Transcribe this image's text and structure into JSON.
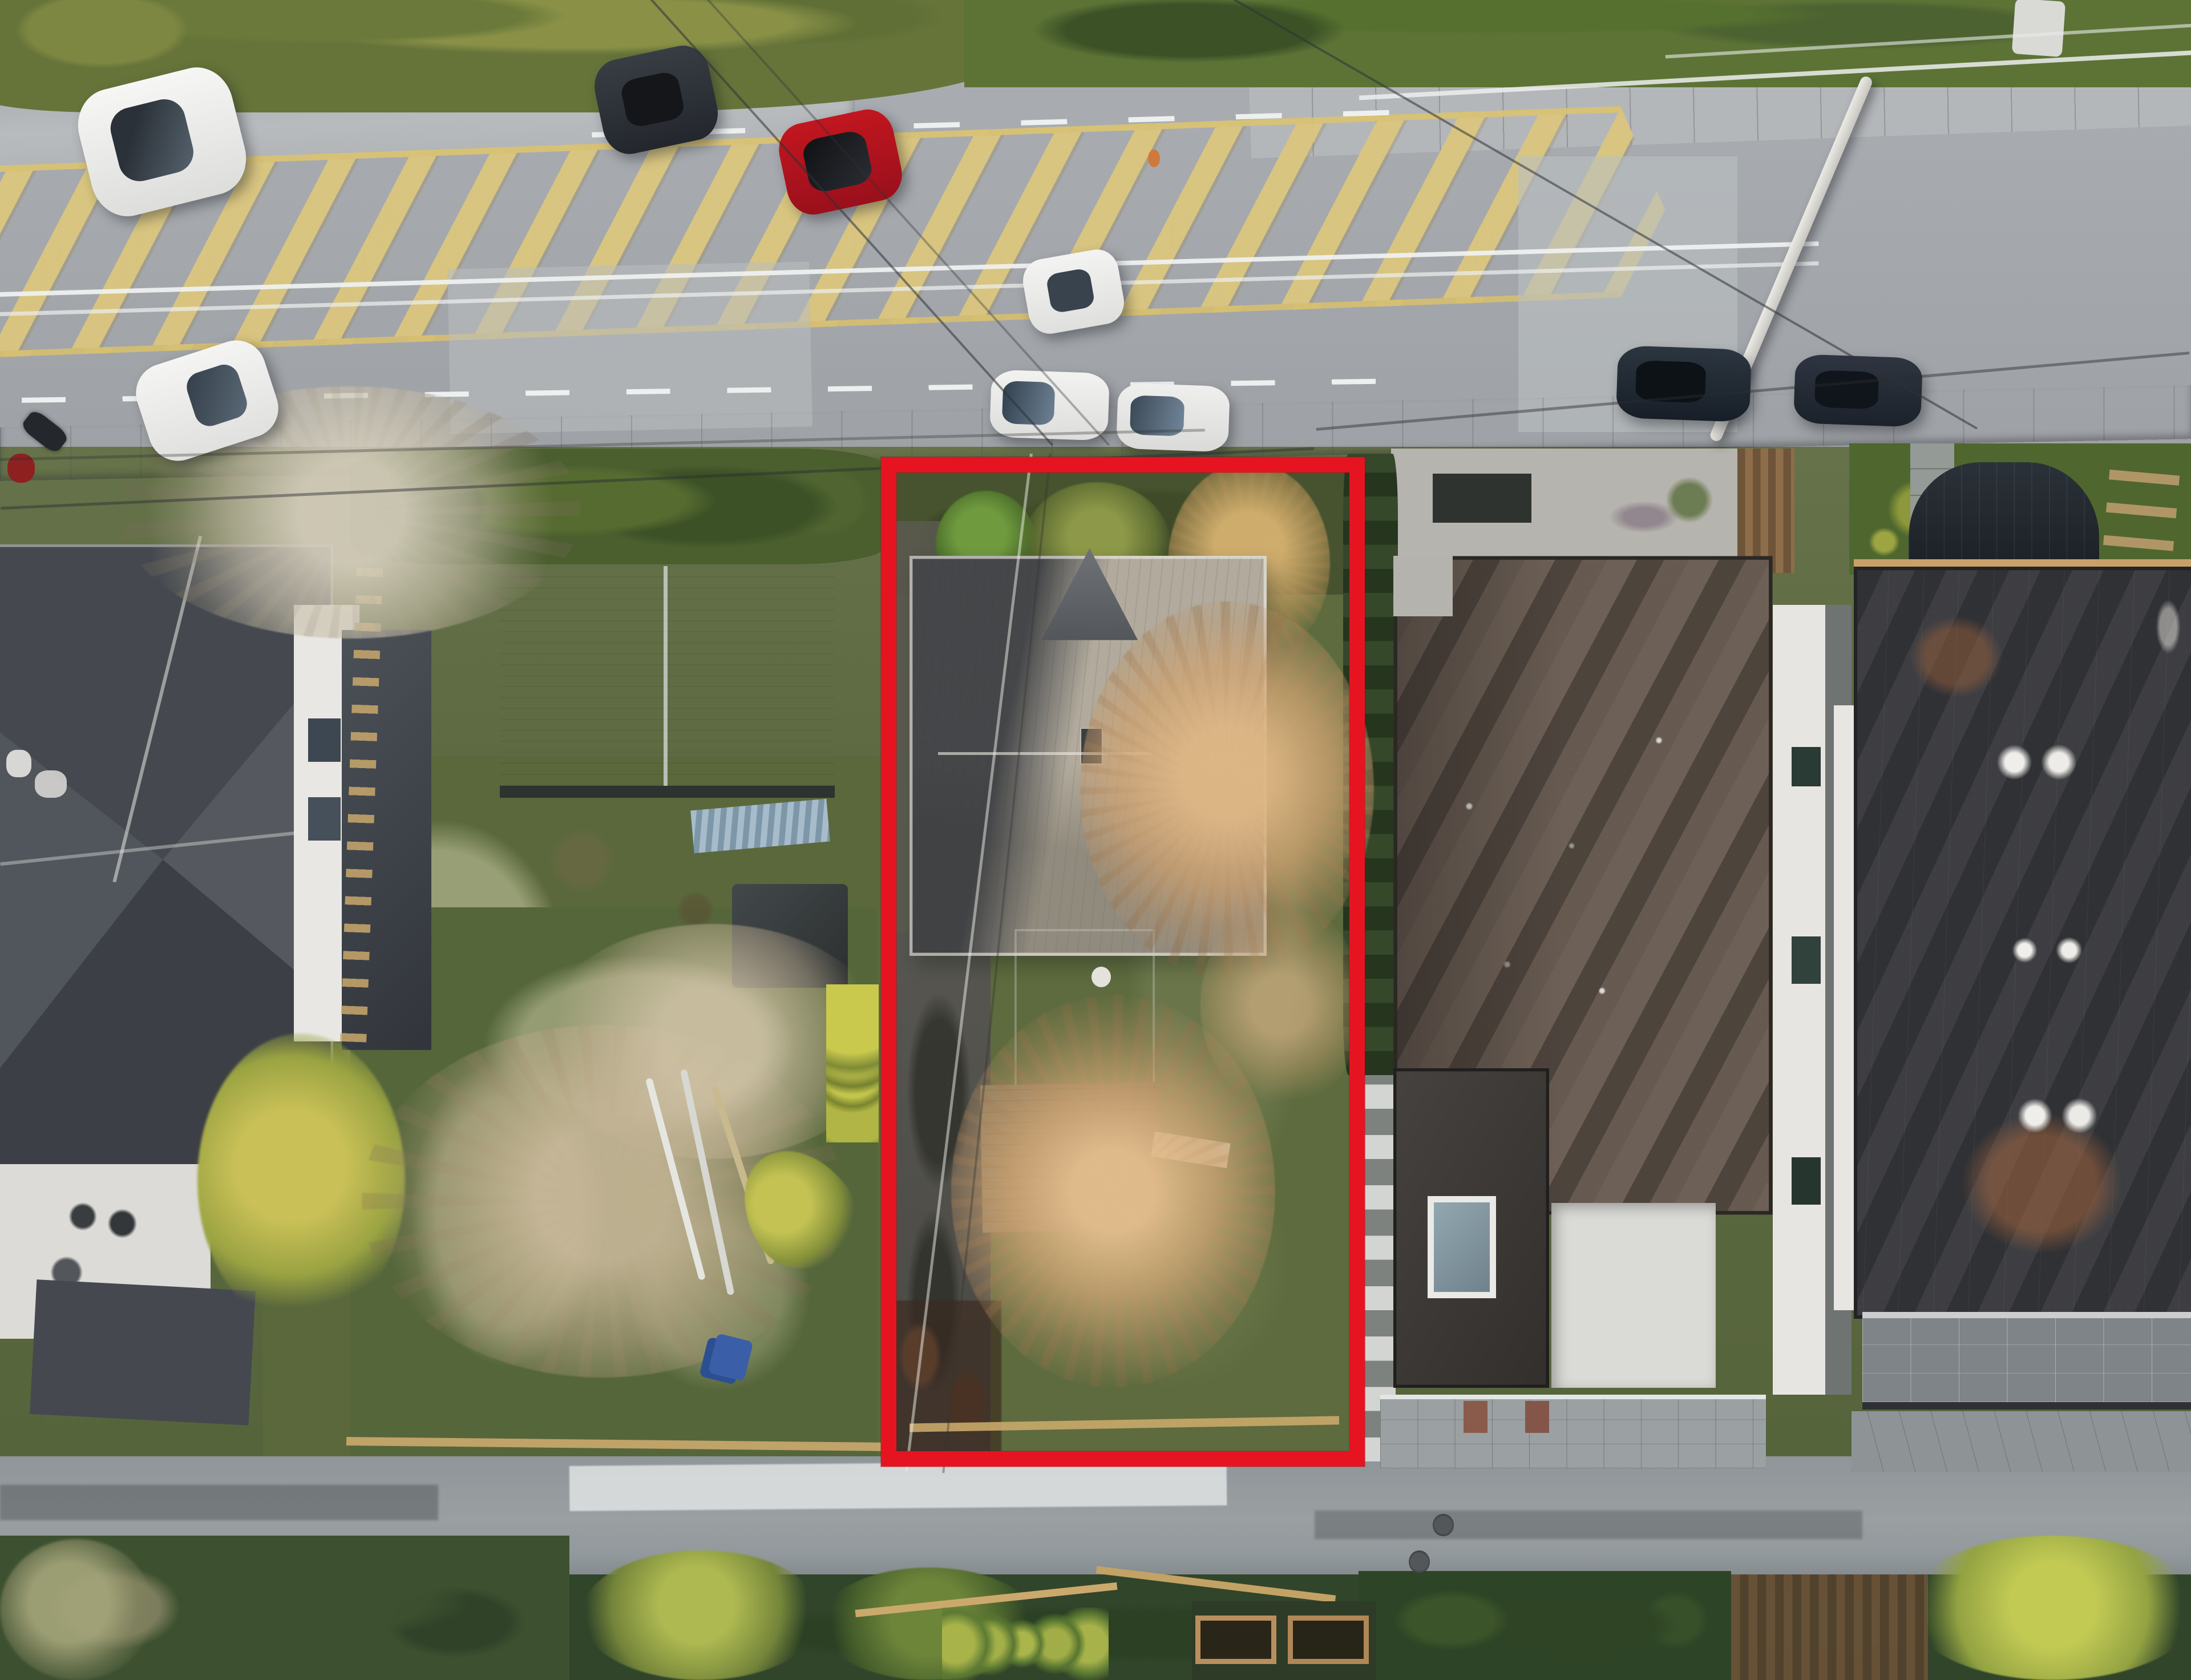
{
  "image": {
    "kind": "aerial-drone-photograph",
    "subject": "single-family redevelopment lot outlined in red between neighboring homes",
    "view": "top-down oblique, low golden-hour sunlight",
    "text_present": false
  },
  "annotation": {
    "name": "property-boundary",
    "shape": "rectangle",
    "color": "#e61420",
    "left_pct": 40.2,
    "top_pct": 27.2,
    "width_pct": 22.1,
    "height_pct": 60.1,
    "border_thickness_pct_of_width": 0.72
  },
  "road": {
    "type": "4-lane arterial with painted median",
    "surface_color": "#a4a8ac",
    "median_marking": {
      "style": "diagonal-hatch",
      "color": "#dbc67e"
    },
    "lane_marking_color": "#eef0f0",
    "sidewalk_color": "#b6b9bb",
    "utility_pole": {
      "color": "#e0dfda",
      "state": "leaning",
      "position": "right"
    },
    "vehicles": [
      {
        "id": "white-suv-westbound",
        "type": "suv",
        "color": "#f4f4f2",
        "state": "driving"
      },
      {
        "id": "white-hatchback-westbound",
        "type": "hatchback",
        "color": "#f2f2f0",
        "state": "driving"
      },
      {
        "id": "dark-suv-westbound",
        "type": "suv",
        "color": "#2c3137",
        "state": "driving"
      },
      {
        "id": "red-coupe-black-roof",
        "type": "coupe",
        "color": "#b5121f",
        "roof_color": "#141519",
        "state": "driving"
      },
      {
        "id": "white-sedan-eastbound",
        "type": "sedan",
        "color": "#f3f3f1",
        "state": "driving"
      },
      {
        "id": "white-hatchback-parked",
        "type": "hatchback",
        "color": "#f0f0ee",
        "state": "parked-at-curb"
      },
      {
        "id": "white-sedan-parked",
        "type": "sedan",
        "color": "#ececea",
        "state": "parked-at-curb"
      },
      {
        "id": "dark-car-parked-1",
        "type": "suv",
        "color": "#1f2731",
        "state": "parked-at-curb"
      },
      {
        "id": "dark-car-parked-2",
        "type": "sedan",
        "color": "#232a33",
        "state": "parked-at-curb"
      },
      {
        "id": "motorcycle-with-rider",
        "type": "motorcycle",
        "color": "#24272b",
        "accent": "#8e2120",
        "state": "on-sidewalk"
      }
    ]
  },
  "subject_lot": {
    "outlined": true,
    "features": [
      "gray-shingle hip/gable house",
      "detached dark flat-roof garage",
      "weathered wood deck",
      "two large bare winter trees lit orange",
      "golden tree at street side",
      "asphalt driveway strip",
      "overgrown lawn",
      "dead brush at lane corner",
      "low wooden fence at rear"
    ],
    "house_roof_colors": [
      "#3c4046",
      "#b2ab9d"
    ],
    "garage_roof_color": "#453f3b",
    "deck_color": "#84755a",
    "driveway_color": "#504f49",
    "tree_branch_color": "#ddb286",
    "grass_color": "#5d6b3e"
  },
  "left_neighbor": {
    "features": [
      "large charcoal multi-hip roof house",
      "white upper walls with windows",
      "white balcony deck with furniture",
      "yellow-green tree",
      "wood trellis fence"
    ],
    "roof_color": "#474b52"
  },
  "left_middle_property": {
    "features": [
      "gable-roof outbuilding",
      "unfinished plywood deck with stacked lumber",
      "small dark shed",
      "weedy backyard",
      "white pipes and debris",
      "blue bins",
      "row of small cypress balls",
      "leaning cypress"
    ],
    "outbuilding_roof_color": "#808892",
    "plywood_color": "#c6b597"
  },
  "right_neighbor": {
    "features": [
      "modern flat-roof house",
      "tree-shadowed brown membrane roof with white vents",
      "gravel front yard with planter",
      "dark lower wing with skylight",
      "white patio roof",
      "paver driveway with two red accent pavers"
    ],
    "roof_color": "#6e6157"
  },
  "far_right_house": {
    "features": [
      "modern flat-roof house",
      "charcoal membrane roof with paired white vents and rust stains",
      "tiled balcony",
      "rear garden with curved dark shed",
      "ladder-style wood fence",
      "stepping-stone path"
    ],
    "roof_color": "#414246"
  },
  "rear_lane": {
    "surface_color": "#949a9d",
    "features": [
      "white painted patch",
      "two manhole covers",
      "wood rail fences",
      "planter boxes",
      "hedges and bright yellow-green trees"
    ]
  },
  "vegetation_palette": {
    "dark_hedge": "#35482a",
    "grass": "#5c7038",
    "bright_tree": "#aeb951",
    "olive_hedge": "#66743a",
    "bare_branches_silver": "#d7d0be",
    "bare_branches_orange": "#ddb286"
  }
}
